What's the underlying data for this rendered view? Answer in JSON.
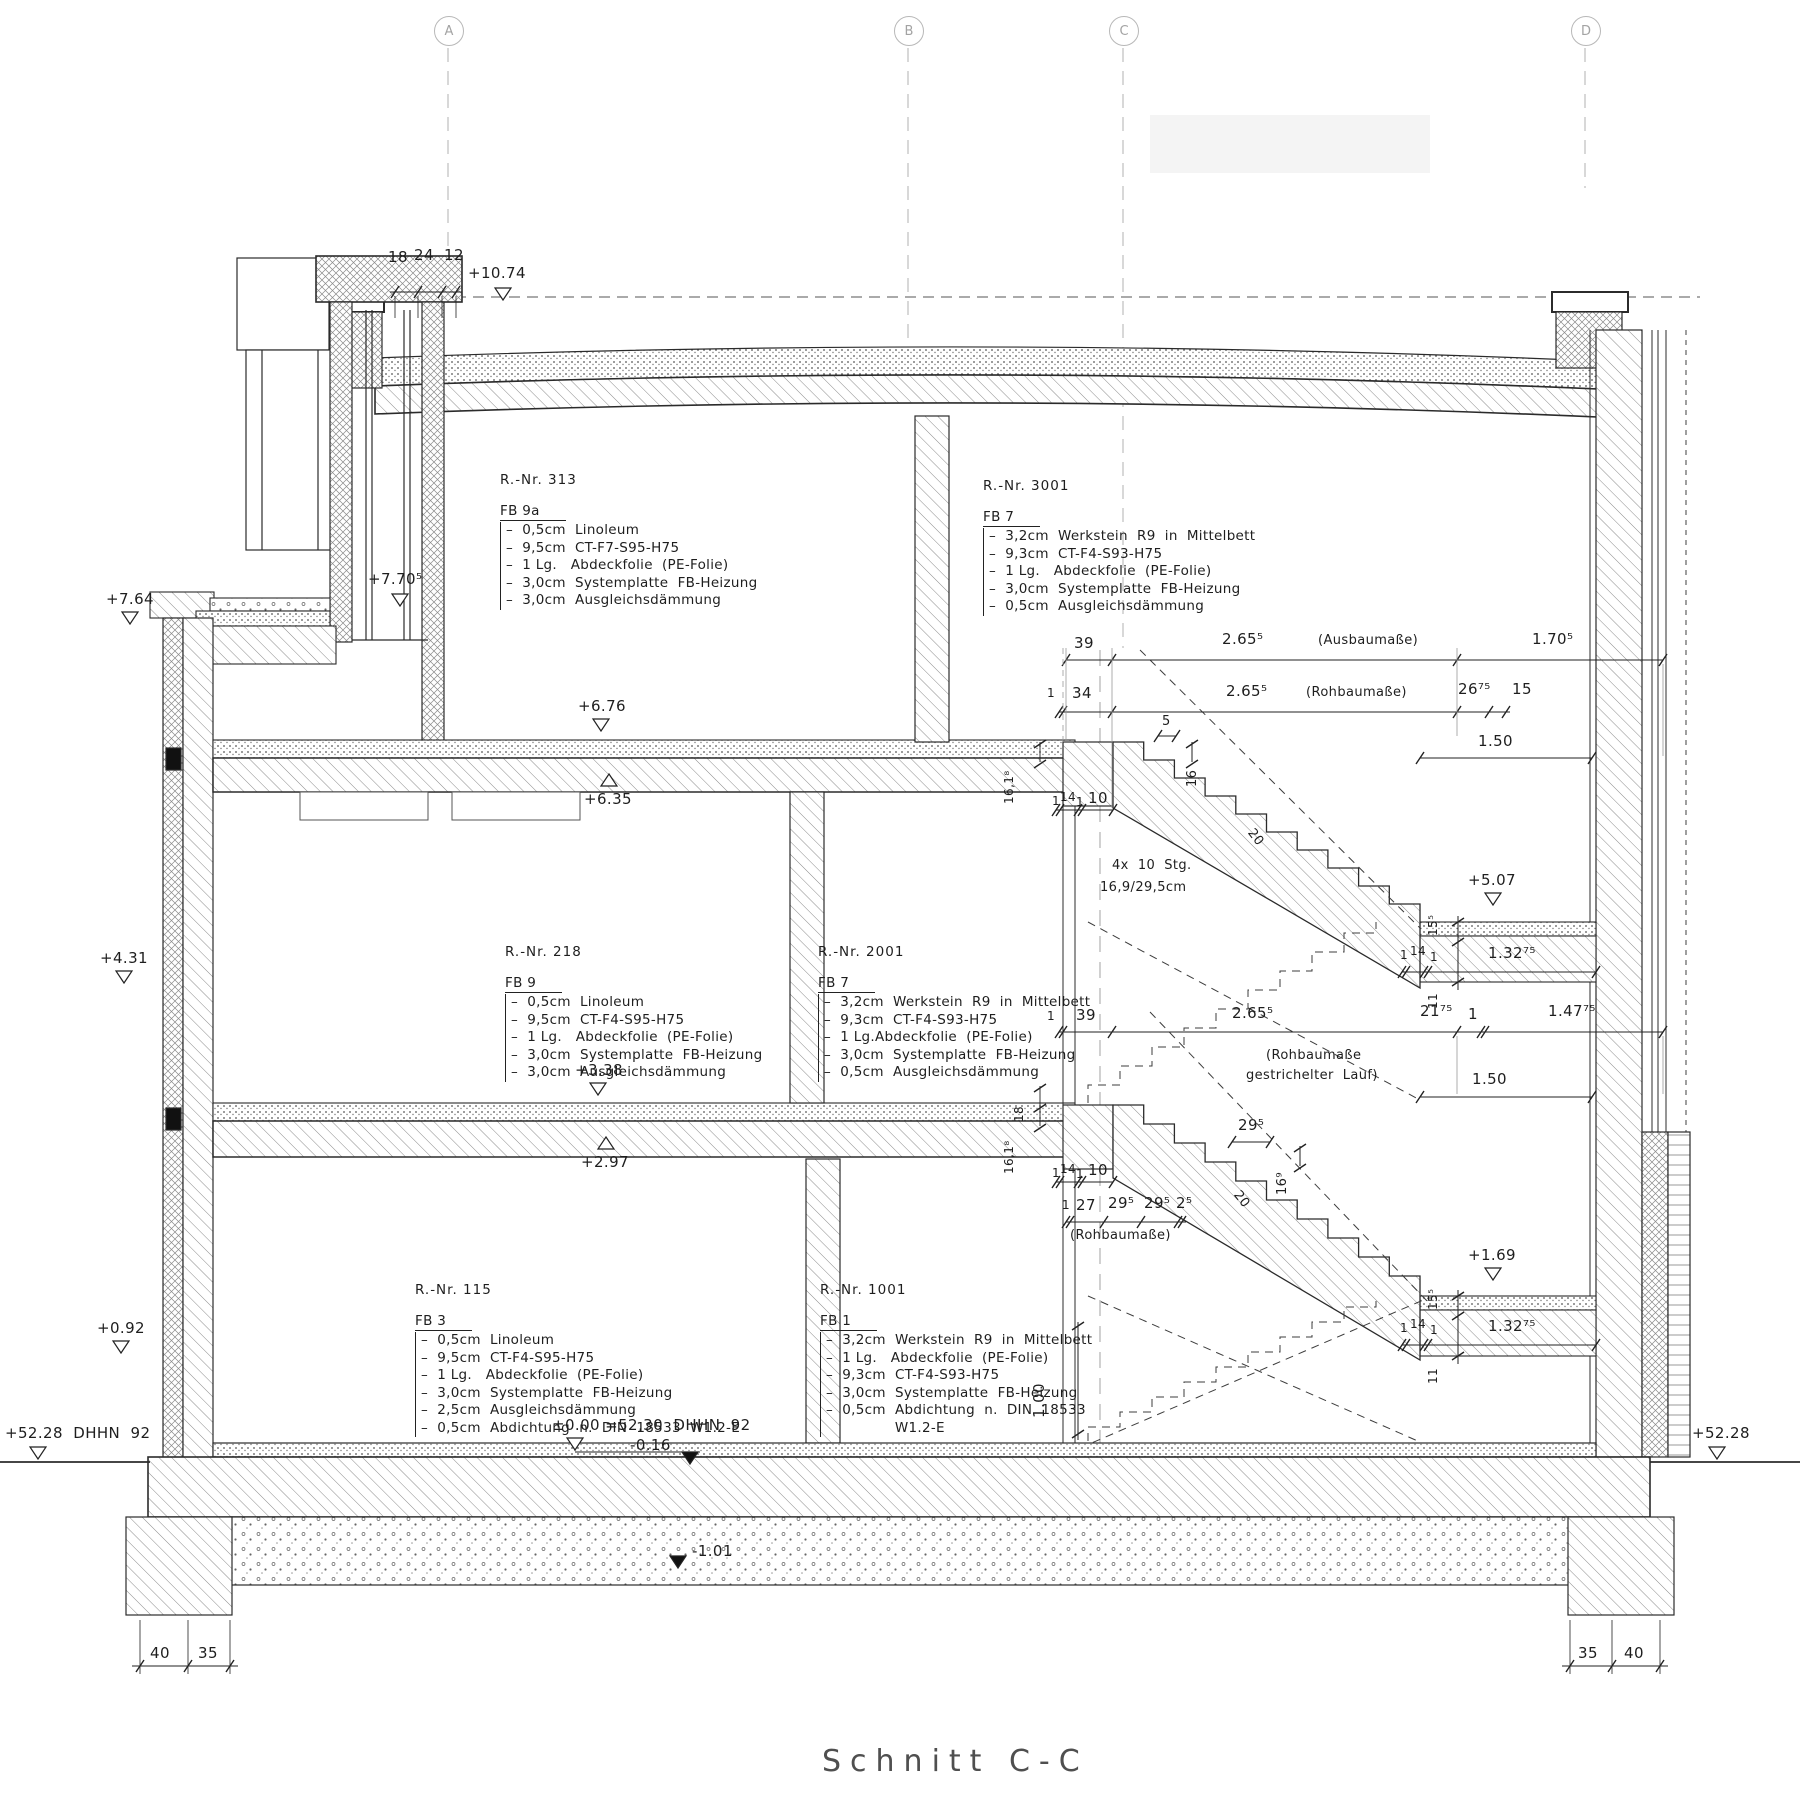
{
  "drawing": {
    "title": "Schnitt C-C"
  },
  "grid": {
    "a": "A",
    "b": "B",
    "c": "C",
    "d": "D"
  },
  "elevations": {
    "e1074": "+10.74",
    "e770": "+7.70⁵",
    "e764": "+7.64",
    "e676": "+6.76",
    "e635": "+6.35",
    "e507": "+5.07",
    "e431": "+4.31",
    "e338": "+3.38",
    "e297": "+2.97",
    "e169": "+1.69",
    "e092": "+0.92",
    "e000": "±0.00 =52,30  DHHN  92",
    "em016": "-0.16",
    "em101": "-1.01",
    "datum_left": "+52.28  DHHN  92",
    "datum_right": "+52.28"
  },
  "rooms": {
    "r313": {
      "nr": "R.-Nr.  313",
      "fb": "FB  9a",
      "layers": [
        "–  0,5cm  Linoleum",
        "–  9,5cm  CT-F7-S95-H75",
        "–  1 Lg.   Abdeckfolie  (PE-Folie)",
        "–  3,0cm  Systemplatte  FB-Heizung",
        "–  3,0cm  Ausgleichsdämmung"
      ]
    },
    "r3001": {
      "nr": "R.-Nr.  3001",
      "fb": "FB  7",
      "layers": [
        "–  3,2cm  Werkstein  R9  in  Mittelbett",
        "–  9,3cm  CT-F4-S93-H75",
        "–  1 Lg.   Abdeckfolie  (PE-Folie)",
        "–  3,0cm  Systemplatte  FB-Heizung",
        "–  0,5cm  Ausgleichsdämmung"
      ]
    },
    "r218": {
      "nr": "R.-Nr.  218",
      "fb": "FB  9",
      "layers": [
        "–  0,5cm  Linoleum",
        "–  9,5cm  CT-F4-S95-H75",
        "–  1 Lg.   Abdeckfolie  (PE-Folie)",
        "–  3,0cm  Systemplatte  FB-Heizung",
        "–  3,0cm  Ausgleichsdämmung"
      ]
    },
    "r2001": {
      "nr": "R.-Nr.  2001",
      "fb": "FB  7",
      "layers": [
        "–  3,2cm  Werkstein  R9  in  Mittelbett",
        "–  9,3cm  CT-F4-S93-H75",
        "–  1 Lg.Abdeckfolie  (PE-Folie)",
        "–  3,0cm  Systemplatte  FB-Heizung",
        "–  0,5cm  Ausgleichsdämmung"
      ]
    },
    "r115": {
      "nr": "R.-Nr.  115",
      "fb": "FB  3",
      "layers": [
        "–  0,5cm  Linoleum",
        "–  9,5cm  CT-F4-S95-H75",
        "–  1 Lg.   Abdeckfolie  (PE-Folie)",
        "–  3,0cm  Systemplatte  FB-Heizung",
        "–  2,5cm  Ausgleichsdämmung",
        "–  0,5cm  Abdichtung  n.  DIN  18533  W1.2-E"
      ]
    },
    "r1001": {
      "nr": "R.-Nr.  1001",
      "fb": "FB  1",
      "layers": [
        "–  3,2cm  Werkstein  R9  in  Mittelbett",
        "–  1 Lg.   Abdeckfolie  (PE-Folie)",
        "–  9,3cm  CT-F4-S93-H75",
        "–  3,0cm  Systemplatte  FB-Heizung",
        "–  0,5cm  Abdichtung  n.  DIN  18533",
        "               W1.2-E"
      ]
    }
  },
  "stair": {
    "note1": "4x  10  Stg.",
    "note2": "16,9/29,5cm"
  },
  "dims": {
    "top": {
      "d18": "18",
      "d24": "24",
      "d12": "12"
    },
    "ausbau": {
      "a39": "39",
      "a265": "2.65⁵",
      "note": "(Ausbaumaße)",
      "a170": "1.70⁵"
    },
    "rohbau": {
      "r1": "1",
      "r34": "34",
      "r265": "2.65⁵",
      "note": "(Rohbaumaße)",
      "r2675": "26⁷⁵",
      "r15": "15"
    },
    "mid": {
      "m1": "1",
      "m39": "39",
      "m265": "2.65⁵",
      "m2175": "21⁷⁵",
      "m1b": "1",
      "m14775": "1.47⁷⁵",
      "note1": "(Rohbaumaße",
      "note2": "gestrichelter  Lauf)"
    },
    "right": {
      "d150a": "1.50",
      "d150b": "1.50",
      "d13275a": "1.32⁷⁵",
      "d13275b": "1.32⁷⁵",
      "d155a": "15⁵",
      "d11a": "11",
      "d155b": "15⁵",
      "d11b": "11",
      "c1a": "1",
      "c14a": "14",
      "c1b": "1",
      "c1c": "1",
      "c14b": "14",
      "c1d": "1"
    },
    "stairdims": {
      "s5": "5",
      "s16": "16",
      "s20a": "20",
      "s20b": "20",
      "s295": "29⁵",
      "s169": "16⁹",
      "s1618a": "16,1⁸",
      "s18": "18",
      "s1618b": "16,1⁸",
      "s100": "1.00",
      "u1a": "1",
      "u14a": "14",
      "u1b": "1",
      "u10a": "10",
      "l1a": "1",
      "l14a": "14",
      "l1b": "1",
      "l10a": "10",
      "run1": "1",
      "run27": "27",
      "run295a": "29⁵",
      "run295b": "29⁵",
      "run25": "2⁵",
      "runnote": "(Rohbaumaße)"
    },
    "bottom": {
      "bl40": "40",
      "bl35": "35",
      "br35": "35",
      "br40": "40"
    }
  }
}
